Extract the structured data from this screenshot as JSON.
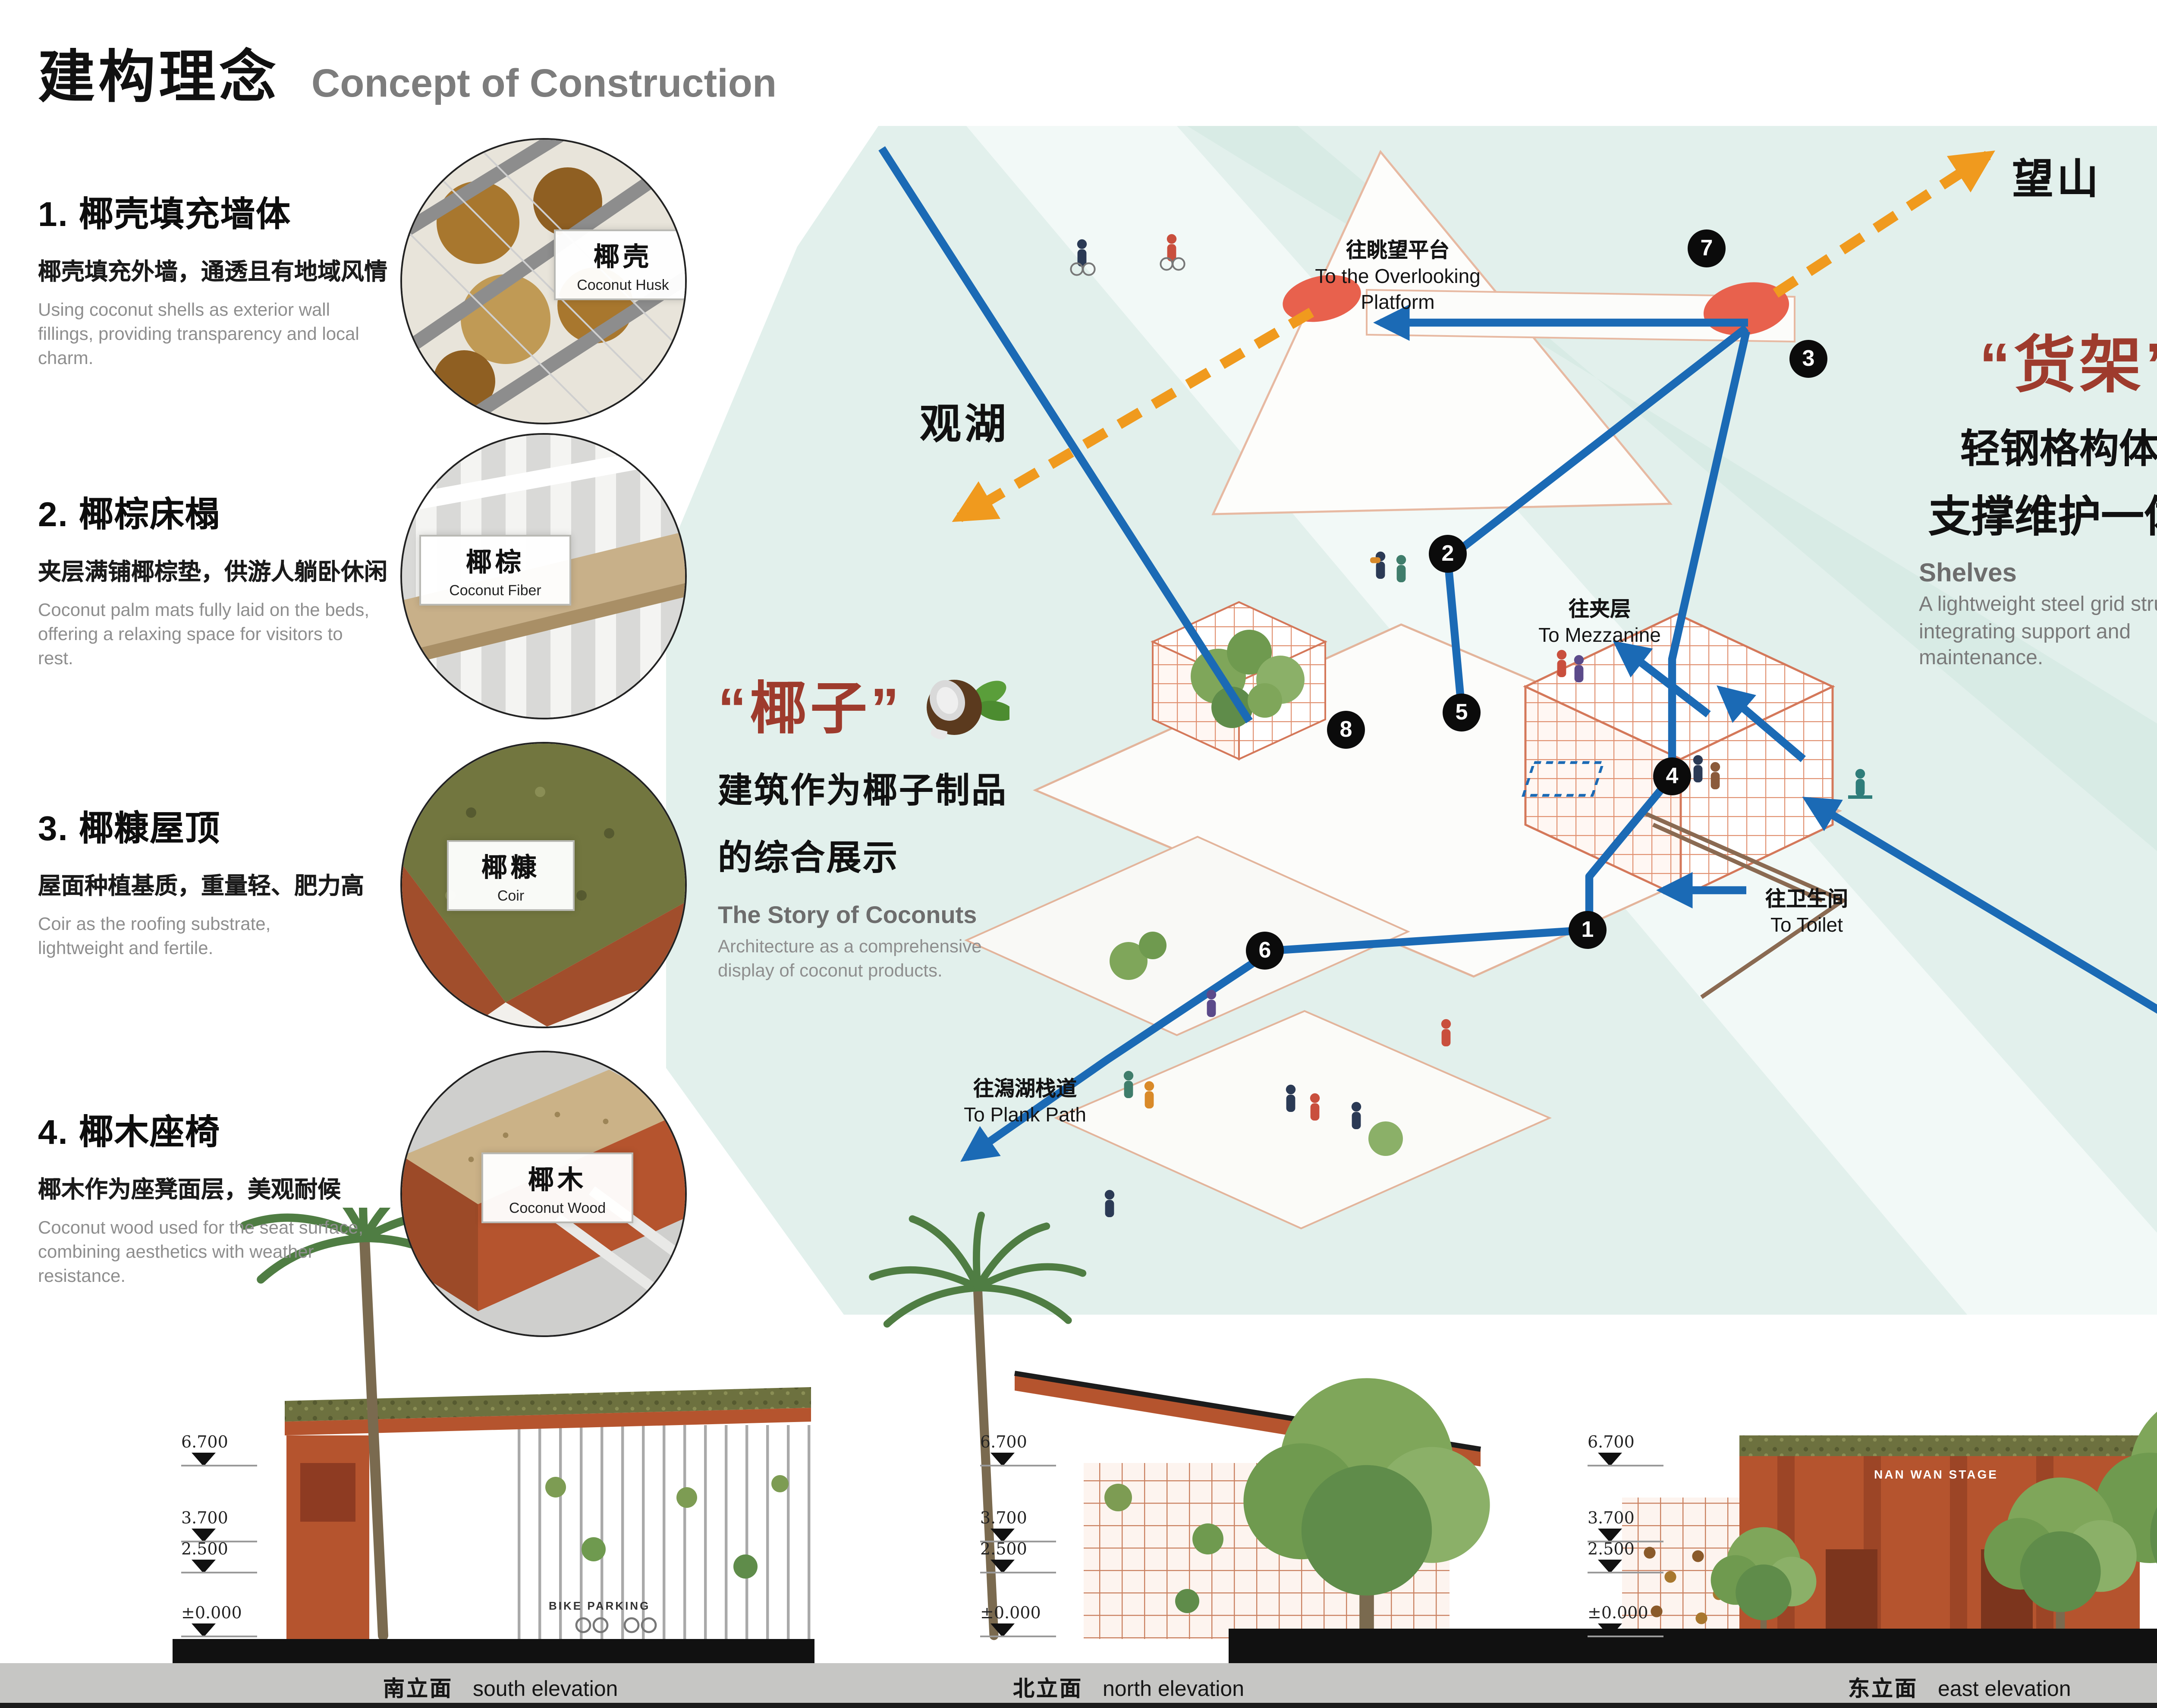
{
  "header": {
    "title_zh": "建构理念",
    "title_en": "Concept of Construction"
  },
  "left_items": [
    {
      "heading": "1. 椰壳填充墙体",
      "sub_zh": "椰壳填充外墙，通透且有地域风情",
      "desc_en": "Using coconut shells as exterior wall fillings, providing transparency and local charm.",
      "badge_zh": "椰壳",
      "badge_en": "Coconut Husk"
    },
    {
      "heading": "2. 椰棕床榻",
      "sub_zh": "夹层满铺椰棕垫，供游人躺卧休闲",
      "desc_en": "Coconut palm mats fully laid on the beds, offering a relaxing space for visitors to rest.",
      "badge_zh": "椰棕",
      "badge_en": "Coconut Fiber"
    },
    {
      "heading": "3. 椰糠屋顶",
      "sub_zh": "屋面种植基质，重量轻、肥力高",
      "desc_en": "Coir as the roofing substrate, lightweight and fertile.",
      "badge_zh": "椰糠",
      "badge_en": "Coir"
    },
    {
      "heading": "4. 椰木座椅",
      "sub_zh": "椰木作为座凳面层，美观耐候",
      "desc_en": "Coconut wood used for the seat surface, combining aesthetics with weather resistance.",
      "badge_zh": "椰木",
      "badge_en": "Coconut Wood"
    }
  ],
  "right_items": [
    {
      "heading": "5. 钢框“货架”",
      "sub_zh": "轻钢格构体系，结构支维护一体化，易于施工",
      "desc_en": "A lightweight steel grid structure that integrates support and maintenance, ensuring easy construction.",
      "badge_zh": "椰壳鸟窝",
      "badge_en": "Coconut Husk"
    },
    {
      "heading": "6. 格栅地板",
      "sub_zh": "架空钢格栅地面，减少对于地面扰动",
      "desc_en": "A lightweight steel grid structure that integrates support and maintenance, ensuring easy construction."
    },
    {
      "heading": "7. 耐候钢板",
      "sub_zh": "免于维护，并可镂空作为标识",
      "desc_en": "Window to the Lagoon – A convergence of Low maintenance and can be hollowed out for signage purposes.",
      "sign": "南湾驿"
    },
    {
      "heading": "8. 炮仗花",
      "sub_zh": "四季常绿，一月到六月盛开红花，恰逢春节旺季，增加节日气氛",
      "desc_en": "Evergreen throughout the year, blooming with red flowers from January to June, creating a festive atmosphere during the Chinese New Year season."
    }
  ],
  "axon": {
    "shelves_block": {
      "quote": "“货架”",
      "line1": "轻钢格构体系",
      "line2": "支撑维护一体化",
      "en_title": "Shelves",
      "en_desc": "A lightweight steel grid structure integrating support and maintenance."
    },
    "coconut_block": {
      "quote": "“椰子”",
      "line1": "建筑作为椰子制品",
      "line2": "的综合展示",
      "en_title": "The Story of Coconuts",
      "en_desc": "Architecture as a comprehensive display of coconut products."
    },
    "labels": {
      "wangshan": "望山",
      "guanhu": "观湖",
      "overlook_zh": "往眺望平台",
      "overlook_en1": "To the Overlooking",
      "overlook_en2": "Platform",
      "mezz_zh": "往夹层",
      "mezz_en": "To Mezzanine",
      "toilet_zh": "往卫生间",
      "toilet_en": "To Toilet",
      "plank_zh": "往潟湖栈道",
      "plank_en": "To Plank Path"
    },
    "markers": [
      "1",
      "2",
      "3",
      "4",
      "5",
      "6",
      "7",
      "8"
    ]
  },
  "bottom": {
    "elevations": [
      {
        "zh": "南立面",
        "en": "south elevation"
      },
      {
        "zh": "北立面",
        "en": "north elevation"
      },
      {
        "zh": "东立面",
        "en": "east elevation"
      },
      {
        "zh": "1-1 剖面",
        "en": "1-1 section"
      }
    ],
    "levels": [
      "6.700",
      "3.700",
      "2.500",
      "±0.000"
    ],
    "east_sign": "NAN WAN STAGE",
    "south_sign": "BIKE PARKING"
  },
  "colors": {
    "accent_red": "#9e3b2d",
    "terracotta": "#b5542e",
    "cyan_bg": "#e2f0ec",
    "blue": "#1b6ab5",
    "orange": "#f09a1e"
  }
}
